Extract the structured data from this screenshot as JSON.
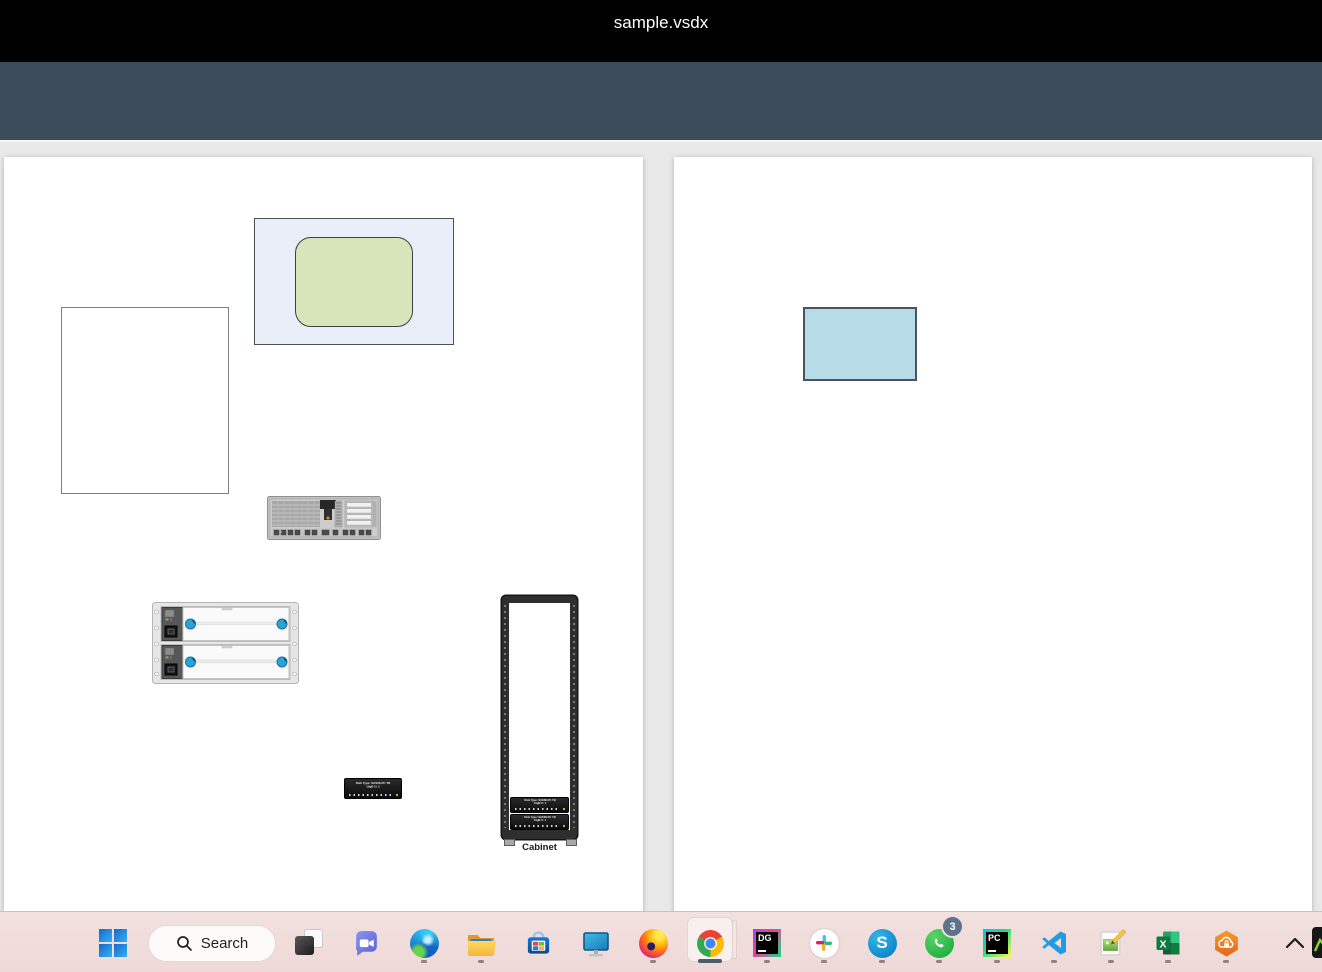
{
  "window": {
    "title": "sample.vsdx"
  },
  "toolbar": {
    "page_indicator": "1/3",
    "buttons": [
      {
        "name": "first-page"
      },
      {
        "name": "previous-page"
      },
      {
        "name": "next-page"
      },
      {
        "name": "last-page"
      },
      {
        "name": "download"
      },
      {
        "name": "print"
      },
      {
        "name": "export-pdf"
      },
      {
        "name": "export-zip"
      }
    ]
  },
  "canvas": {
    "pages": [
      {
        "number": 1,
        "shapes": [
          "container-rectangle",
          "rounded-rectangle",
          "rectangle",
          "server",
          "disk-array",
          "rack-unit",
          "cabinet"
        ]
      },
      {
        "number": 2,
        "shapes": [
          "rectangle"
        ]
      }
    ],
    "cabinet_label": "Cabinet",
    "rack_unit_text": {
      "line1": "Disk Type: SAS08-PC TB",
      "line2": "10gB U: 1"
    }
  },
  "taskbar": {
    "search_label": "Search",
    "whatsapp_badge": "3",
    "datagrip_label": "DG",
    "pycharm_label": "PC",
    "skype_label": "S",
    "excel_label": "X",
    "apps": [
      {
        "name": "start",
        "running": false
      },
      {
        "name": "search",
        "running": false
      },
      {
        "name": "task-view",
        "running": false
      },
      {
        "name": "teams",
        "running": false
      },
      {
        "name": "edge",
        "running": true
      },
      {
        "name": "file-explorer",
        "running": true
      },
      {
        "name": "microsoft-store",
        "running": false
      },
      {
        "name": "display",
        "running": false
      },
      {
        "name": "firefox",
        "running": true
      },
      {
        "name": "chrome",
        "running": true,
        "active": true
      },
      {
        "name": "datagrip",
        "running": true
      },
      {
        "name": "slack",
        "running": true
      },
      {
        "name": "skype",
        "running": true
      },
      {
        "name": "whatsapp",
        "running": true,
        "badge": "3"
      },
      {
        "name": "pycharm",
        "running": true
      },
      {
        "name": "vscode",
        "running": true
      },
      {
        "name": "image-editor",
        "running": true
      },
      {
        "name": "excel",
        "running": true
      },
      {
        "name": "cloud-security",
        "running": true
      }
    ]
  },
  "colors": {
    "titlebar": "#000000",
    "toolbar": "#3d4c5a",
    "canvas_bg": "#e9e9e9",
    "page_bg": "#ffffff",
    "taskbar": "#f0dcda",
    "container_fill": "#e9eef9",
    "rounded_fill": "#d8e4ba",
    "blue_rect_fill": "#b7dbe7",
    "knob_blue": "#2ba3d8"
  }
}
